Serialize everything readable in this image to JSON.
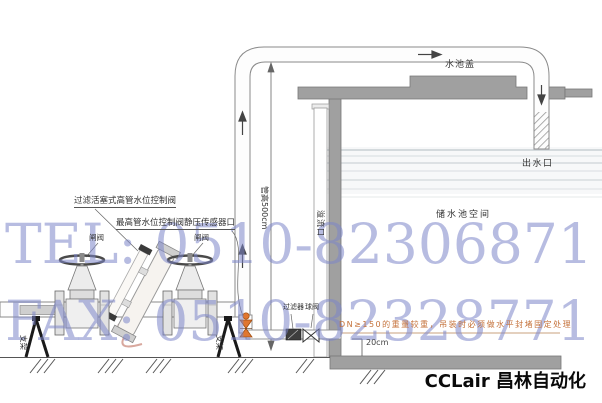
{
  "diagram": {
    "labels": {
      "control_valve": "过滤活塞式高管水位控制阀",
      "sensor_port": "最高管水位控制阀静压传感器口",
      "gate_valve_left": "闸阀",
      "gate_valve_right": "闸阀",
      "tank_cover": "水池盖",
      "outlet": "出水口",
      "tank_space": "储水池空间",
      "overflow_port": "溢流口",
      "pipe_height": "管高500cm",
      "filter": "过滤器",
      "ball_valve": "球阀",
      "level_dim": "20cm",
      "support_left": "支架",
      "support_right": "支架",
      "install_note": "DN≥150的重量较重，吊装时必须做水平封堵固定处理"
    },
    "colors": {
      "tank_gray": "#a0a0a0",
      "pipe_outline": "#8a8a8a",
      "orange_valve": "#e0762f",
      "note_text": "#c4713a",
      "watermark": "#7c85c9"
    }
  },
  "watermark": {
    "line1": "TEL: 0510-82306871",
    "line2": "FAX: 0510-82328771"
  },
  "brand": {
    "name": "CCLair 昌林自动化"
  }
}
